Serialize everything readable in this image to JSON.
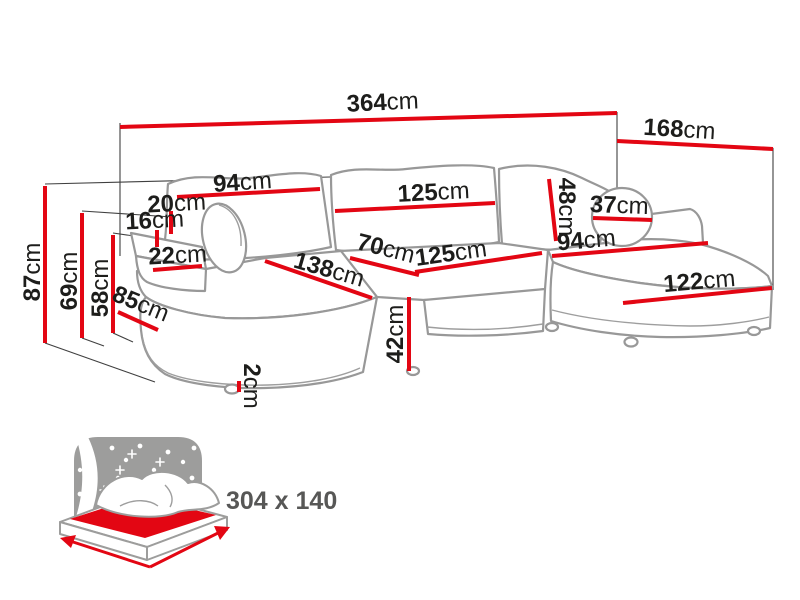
{
  "colors": {
    "dimension_line": "#e30613",
    "label_text": "#1d1d1b",
    "sofa_outline": "#989898",
    "guide_line": "#3f3f3f",
    "icon_gray": "#9d9d9c",
    "size_text": "#575756"
  },
  "diagram": {
    "type": "corner-sofa-dimension-diagram",
    "unit": "cm",
    "measurements": [
      {
        "name": "total-width",
        "value": "364",
        "unit": "cm"
      },
      {
        "name": "total-depth",
        "value": "168",
        "unit": "cm"
      },
      {
        "name": "back-height",
        "value": "87",
        "unit": "cm"
      },
      {
        "name": "armrest-height",
        "value": "69",
        "unit": "cm"
      },
      {
        "name": "seat-back-height",
        "value": "58",
        "unit": "cm"
      },
      {
        "name": "left-back-cushion-width",
        "value": "94",
        "unit": "cm"
      },
      {
        "name": "backrest-top-depth",
        "value": "20",
        "unit": "cm"
      },
      {
        "name": "armrest-top-width",
        "value": "16",
        "unit": "cm"
      },
      {
        "name": "armrest-front-width",
        "value": "22",
        "unit": "cm"
      },
      {
        "name": "chaise-side-depth",
        "value": "85",
        "unit": "cm"
      },
      {
        "name": "chaise-seat-length",
        "value": "138",
        "unit": "cm"
      },
      {
        "name": "middle-back-cushion-width",
        "value": "125",
        "unit": "cm"
      },
      {
        "name": "back-cushion-height",
        "value": "48",
        "unit": "cm"
      },
      {
        "name": "seat-depth",
        "value": "70",
        "unit": "cm"
      },
      {
        "name": "middle-seat-width",
        "value": "125",
        "unit": "cm"
      },
      {
        "name": "right-seat-width",
        "value": "94",
        "unit": "cm"
      },
      {
        "name": "bolster-pillow-diameter",
        "value": "37",
        "unit": "cm"
      },
      {
        "name": "right-chaise-length",
        "value": "122",
        "unit": "cm"
      },
      {
        "name": "seat-height",
        "value": "42",
        "unit": "cm"
      },
      {
        "name": "leg-height",
        "value": "2",
        "unit": "cm"
      }
    ]
  },
  "sleeping_function": {
    "size_label": "304 x 140"
  }
}
